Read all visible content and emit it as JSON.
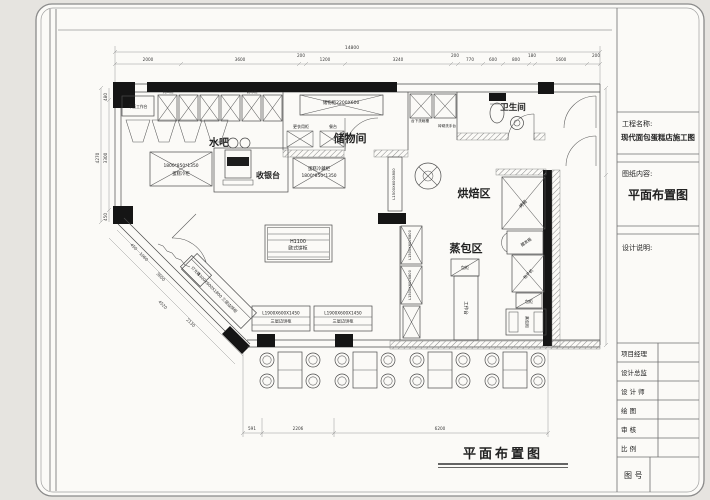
{
  "title_block": {
    "project_label": "工程名称:",
    "project_value": "现代面包蛋糕店施工图",
    "content_label": "图纸内容:",
    "content_value": "平面布置图",
    "notes_label": "设计说明:",
    "rows": [
      "项目经理",
      "设计总监",
      "设 计 师",
      "绘  图",
      "审  核",
      "比  例"
    ],
    "drawing_no": "图  号"
  },
  "plan": {
    "caption": "平面布置图",
    "rooms": {
      "water_bar": "水吧",
      "cashier": "收银台",
      "storage": "储物间",
      "toilet": "卫生间",
      "baking": "烘焙区",
      "steam": "蒸包区"
    },
    "equipment": {
      "worktop": "平面工作台",
      "sealer": "封口机",
      "ice_maker": "制冰机",
      "cake_fridge_left_size": "1800*850*1350",
      "cake_fridge_left_name": "蛋糕冷柜",
      "cake_fridge_mid_name": "蛋糕冷藏柜",
      "cake_fridge_mid_size": "1800*850*1350",
      "storage_cabinet": "储物柜2200X600",
      "locker": "更衣用柜",
      "dining_table": "餐台",
      "under_sink": "台下洗碗槽",
      "wash_basin": "砖砌洗手台",
      "island_height": "H1100",
      "island_name": "欧式饼柜",
      "shelf_size": "L1900X600X1450",
      "shelf_name": "三层边饼柜",
      "diag_shelf": "1300X600X1800 三层边饼柜",
      "light_box": "灯光箱",
      "mid_cabinet_size": "L1500X600X800",
      "oven": "烤箱",
      "proofer": "醒发箱",
      "bun_machine": "包子机",
      "bun_cabinet": "包柜",
      "steam_cabinet": "蒸包柜",
      "work_table": "工作台"
    },
    "dims": {
      "top_overall": "14800",
      "top": [
        "2000",
        "3600",
        "200",
        "1200",
        "3240",
        "200",
        "770",
        "600",
        "800",
        "180",
        "1600",
        "200"
      ],
      "left": [
        "480",
        "4270",
        "3300",
        "450"
      ],
      "bottom": [
        "591",
        "2206",
        "6200"
      ],
      "diag": [
        "450",
        "1060",
        "3600",
        "4520",
        "2130"
      ]
    }
  }
}
